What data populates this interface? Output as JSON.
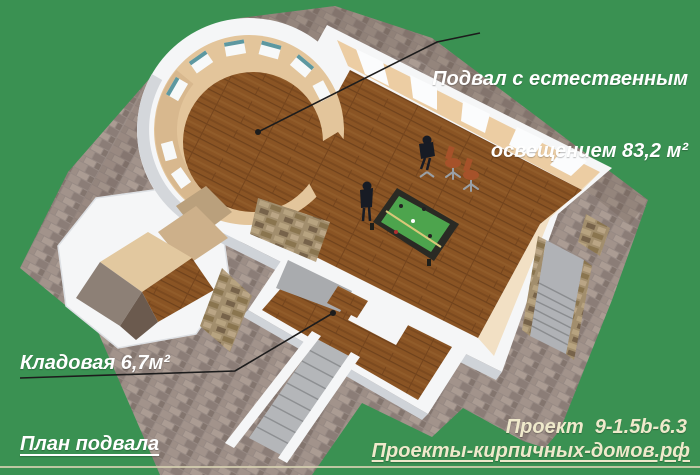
{
  "annotations": {
    "basement_area_label": {
      "line1": "Подвал с естественным",
      "line2": "освещением 83,2 м²"
    },
    "storage_label": "Кладовая 6,7м²",
    "plan_title": "План подвала",
    "project_code": "Проект  9-1.5b-6.3",
    "website": "Проекты-кирпичных-домов.рф"
  },
  "colors": {
    "background_lawn": "#3a9152",
    "label_white": "#ffffff",
    "label_cream": "#efe9cb",
    "annotation_line": "#1c1c1c",
    "wall_white": "#f5f6f7",
    "wall_beige": "#eccda3",
    "wood_floor": "#8a5424",
    "billiard_cloth": "#4da44d",
    "pavement_grey": "#978a84",
    "stool_brown": "#a6522a",
    "stair_grey": "#b4b6b9"
  }
}
